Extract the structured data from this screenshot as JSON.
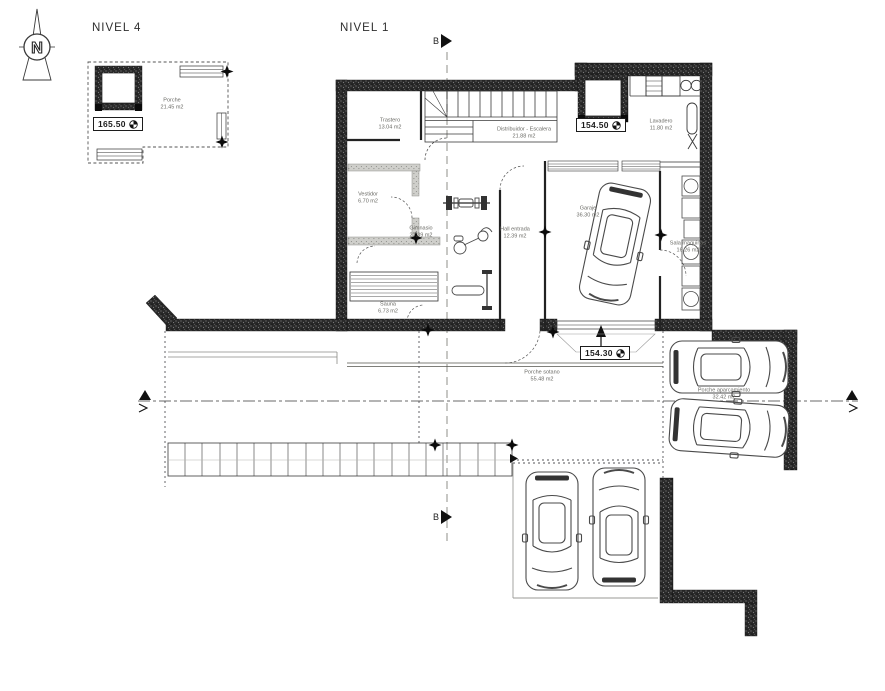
{
  "titles": {
    "nivel4": "NIVEL 4",
    "nivel1": "NIVEL 1"
  },
  "north": {
    "letter": "N"
  },
  "section": {
    "b": "B"
  },
  "levels": {
    "porche_n4": "165.50",
    "distribuidor": "154.50",
    "porche_sotano": "154.30"
  },
  "rooms": {
    "porche_n4": {
      "name": "Porche",
      "area": "21.45 m2"
    },
    "trastero": {
      "name": "Trastero",
      "area": "13.04 m2"
    },
    "distribuidor": {
      "name": "Distribuidor - Escalera",
      "area": "21.88 m2"
    },
    "lavadero": {
      "name": "Lavadero",
      "area": "11.80 m2"
    },
    "vestidor": {
      "name": "Vestidor",
      "area": "6.70 m2"
    },
    "gimnasio": {
      "name": "Gimnasio",
      "area": "27.39 m2"
    },
    "hall": {
      "name": "Hall entrada",
      "area": "12.39 m2"
    },
    "garaje": {
      "name": "Garaje",
      "area": "36.30 m2"
    },
    "sala_maquinas": {
      "name": "Sala maquinas",
      "area": "16.26 m2"
    },
    "sauna": {
      "name": "Sauna",
      "area": "6.73 m2"
    },
    "porche_sotano": {
      "name": "Porche sotano",
      "area": "55.48 m2"
    },
    "porche_aparcamiento": {
      "name": "Porche aparcamiento",
      "area": "32.42 m2"
    }
  },
  "colors": {
    "wall": "#262626",
    "line": "#3a3a3a",
    "label": "#6b6b66"
  }
}
